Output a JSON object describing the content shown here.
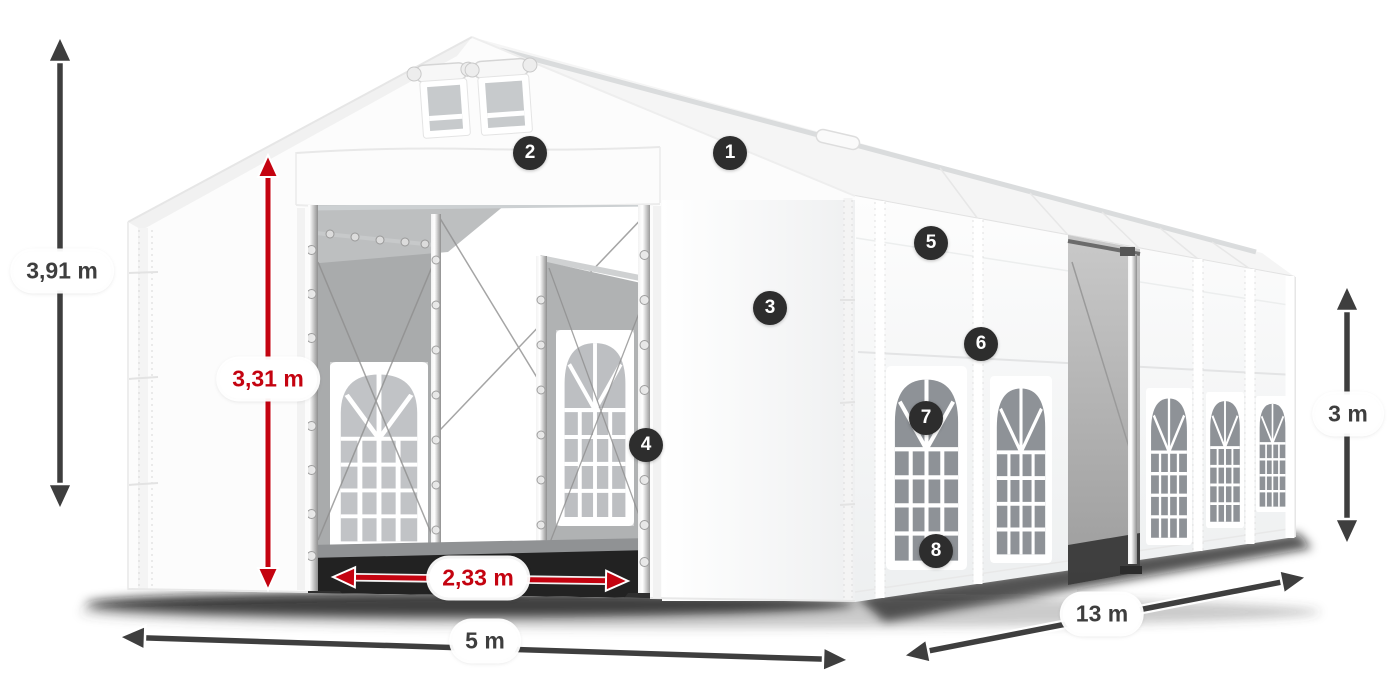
{
  "page": {
    "background": "#ffffff",
    "description": "3D render of a white marquee tent with numbered feature markers and dimension arrows"
  },
  "dimensions": {
    "unit": "m",
    "total_height": {
      "label": "3,91 m",
      "style": "dark"
    },
    "entrance_height": {
      "label": "3,31 m",
      "style": "red"
    },
    "entrance_width": {
      "label": "2,33 m",
      "style": "red"
    },
    "front_width": {
      "label": "5 m",
      "style": "dark"
    },
    "side_length": {
      "label": "13 m",
      "style": "dark"
    },
    "side_wall_height": {
      "label": "3 m",
      "style": "dark"
    }
  },
  "markers": [
    {
      "number": "1"
    },
    {
      "number": "2"
    },
    {
      "number": "3"
    },
    {
      "number": "4"
    },
    {
      "number": "5"
    },
    {
      "number": "6"
    },
    {
      "number": "7"
    },
    {
      "number": "8"
    }
  ],
  "colors": {
    "accent_red": "#c40310",
    "arrow_dark": "#3e3e3e",
    "marker_bg": "#2d2d2d",
    "marker_text": "#ffffff",
    "label_bg": "#ffffff",
    "label_text": "#3e3e3e"
  }
}
